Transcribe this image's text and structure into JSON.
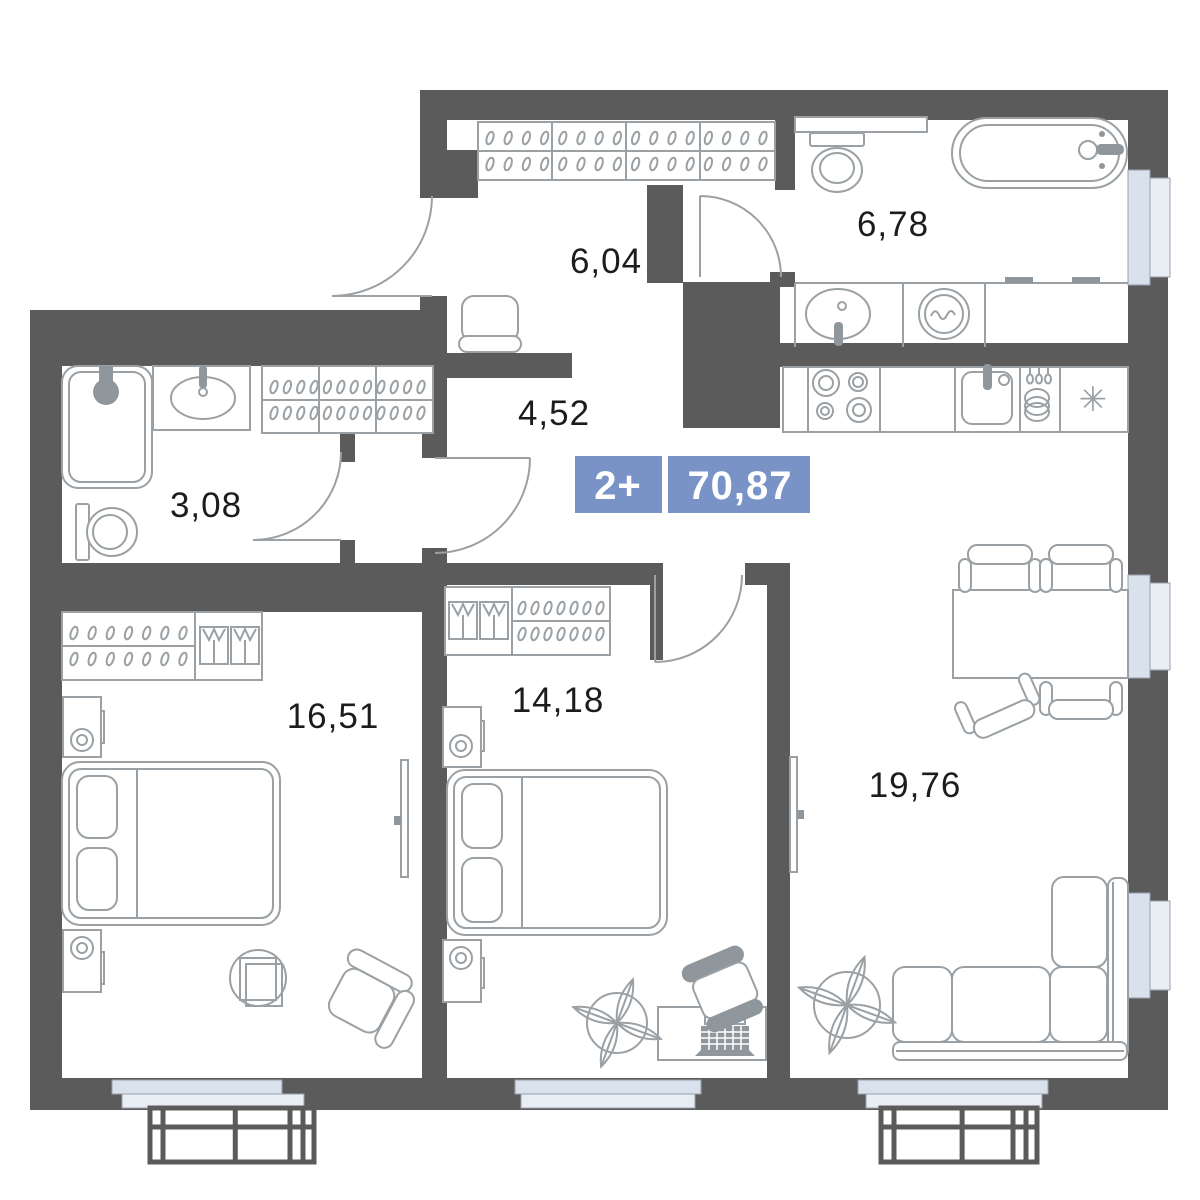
{
  "badge": {
    "rooms": "2+",
    "area": "70,87"
  },
  "rooms": {
    "hallway": {
      "area": "6,04"
    },
    "bathroom_main": {
      "area": "6,78"
    },
    "corridor": {
      "area": "4,52"
    },
    "bathroom_small": {
      "area": "3,08"
    },
    "bedroom_1": {
      "area": "16,51"
    },
    "bedroom_2": {
      "area": "14,18"
    },
    "living_kitchen": {
      "area": "19,76"
    }
  },
  "kitchen": {
    "fridge_symbol": "✳"
  },
  "colors": {
    "wall": "#5b5b5b",
    "furniture": "#9aa0a4",
    "furniture_dark": "#8f979c",
    "window": "#d9e1ec",
    "window_outer": "#e9eef5",
    "badge": "#7a93c7",
    "label_text": "#1c1c1c"
  }
}
